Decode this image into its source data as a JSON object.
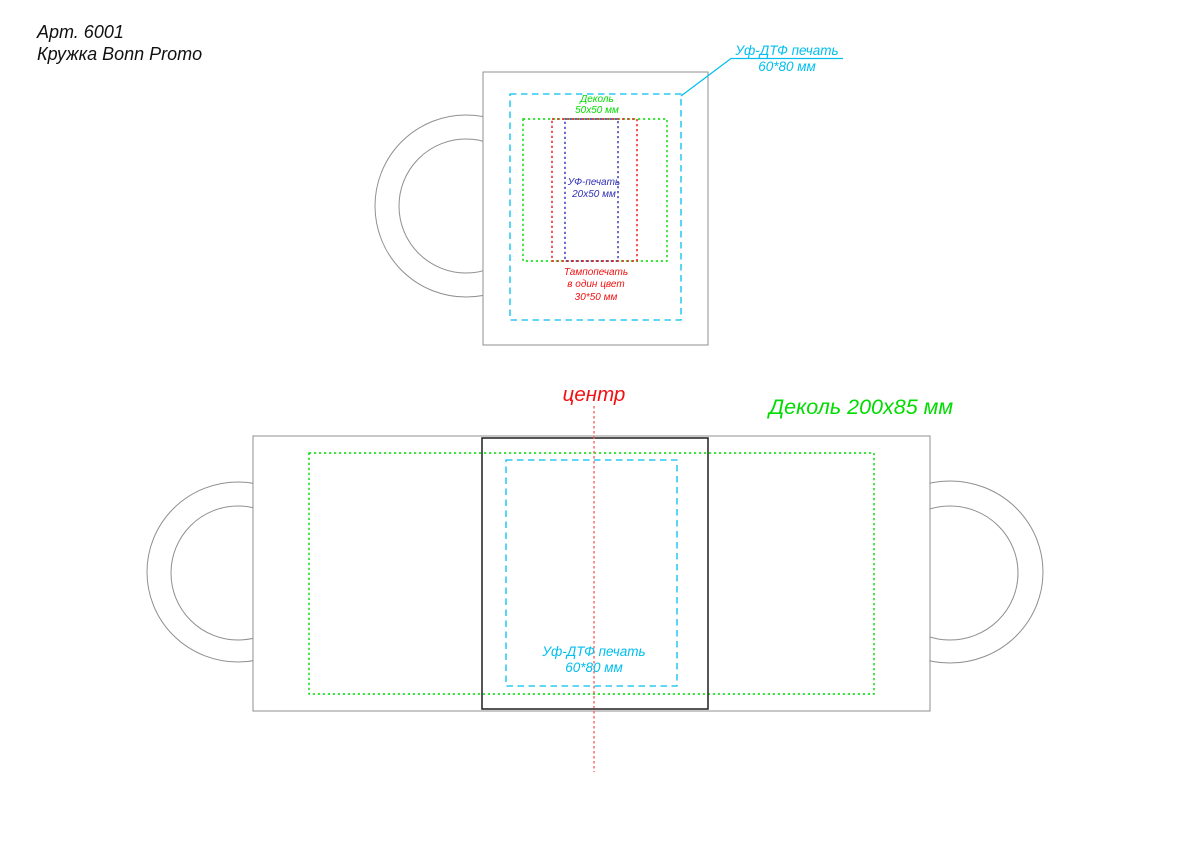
{
  "title": {
    "article": "Арт. 6001",
    "product": "Кружка Bonn Promo"
  },
  "colors": {
    "cyan": "#00bfef",
    "green": "#00dc00",
    "red": "#f01212",
    "red_line": "#ff5555",
    "blue": "#3030b4",
    "outline": "#8f8f8f",
    "panel": "#1f1f1f",
    "ink": "#111111"
  },
  "top_view": {
    "decal_label": {
      "line1": "Деколь",
      "line2": "50x50 мм"
    },
    "uv_print_label": {
      "line1": "УФ-печать",
      "line2": "20x50 мм"
    },
    "pad_print_label": {
      "line1": "Тампопечать",
      "line2": "в один цвет",
      "line3": "30*50 мм"
    },
    "uv_dtf_callout": {
      "line1": "Уф-ДТФ печать",
      "line2": "60*80 мм"
    }
  },
  "bottom_view": {
    "center_marker": "центр",
    "decal_label": "Деколь 200x85 мм",
    "uv_dtf_label": {
      "line1": "Уф-ДТФ печать",
      "line2": "60*80 мм"
    }
  }
}
